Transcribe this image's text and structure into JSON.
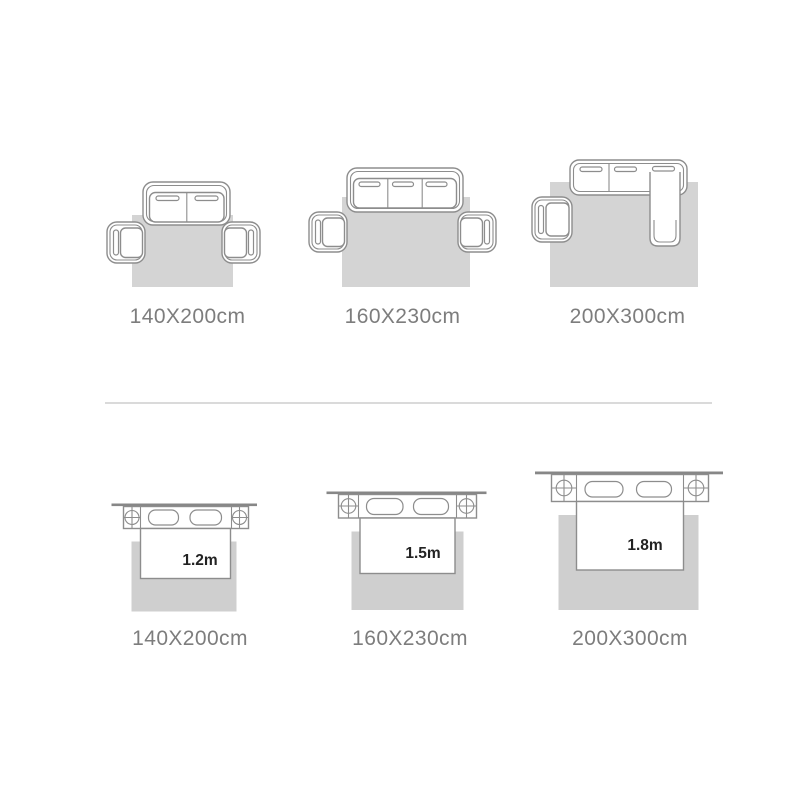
{
  "colors": {
    "background": "#ffffff",
    "outline": "#8d8d8d",
    "wall": "#878787",
    "rug_sofa": "#d4d4d4",
    "rug_bed": "#cfcfcf",
    "caption": "#7d7d7d",
    "bed_label": "#222222",
    "divider": "#dadada"
  },
  "sofa_row": {
    "items": [
      {
        "rug_size_label": "140X200cm"
      },
      {
        "rug_size_label": "160X230cm"
      },
      {
        "rug_size_label": "200X300cm"
      }
    ]
  },
  "bed_row": {
    "items": [
      {
        "bed_width_label": "1.2m",
        "rug_size_label": "140X200cm"
      },
      {
        "bed_width_label": "1.5m",
        "rug_size_label": "160X230cm"
      },
      {
        "bed_width_label": "1.8m",
        "rug_size_label": "200X300cm"
      }
    ]
  }
}
